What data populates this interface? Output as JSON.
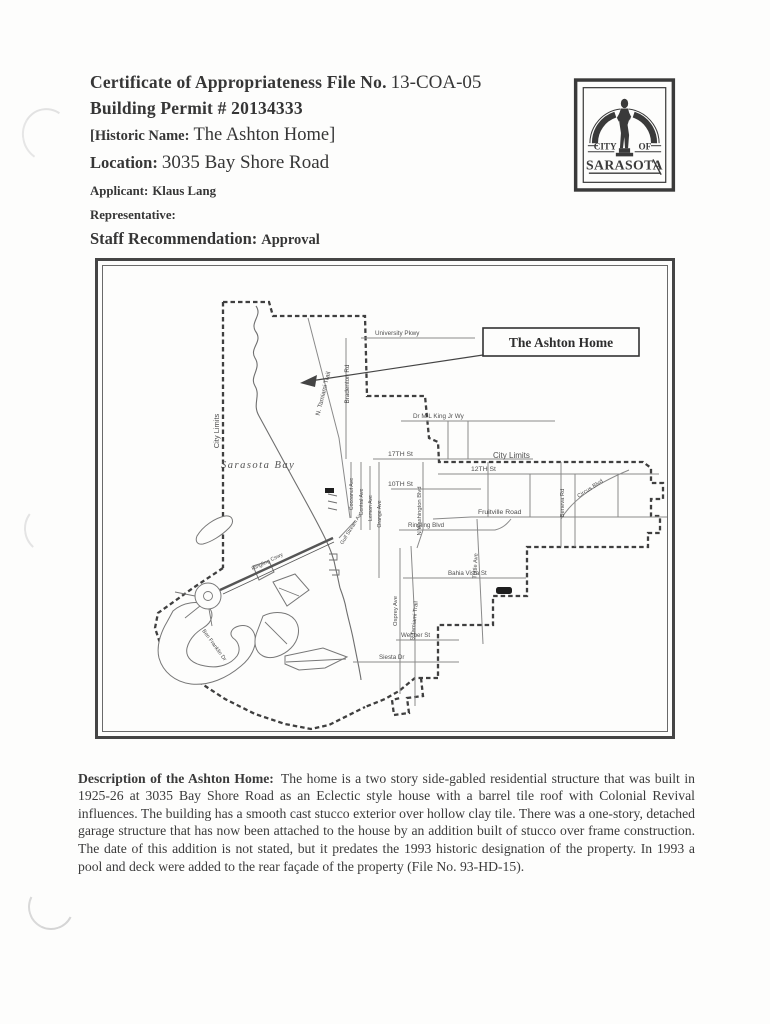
{
  "document": {
    "header": {
      "certificate_label": "Certificate of Appropriateness File No.",
      "certificate_value": "13-COA-05",
      "building_permit": "Building Permit # 20134333",
      "historic_name_label": "[Historic Name:",
      "historic_name_value": "The Ashton Home]",
      "location_label": "Location:",
      "location_value": "3035 Bay Shore Road",
      "applicant_label": "Applicant:",
      "applicant_value": "Klaus Lang",
      "representative_label": "Representative:",
      "staff_recommendation_label": "Staff Recommendation:",
      "staff_recommendation_value": "Approval"
    },
    "logo": {
      "city_word": "CITY",
      "of_word": "OF",
      "name_word": "SARASOTA"
    },
    "map": {
      "callout_label": "The Ashton Home",
      "labels": {
        "city_limits_left": "City Limits",
        "city_limits_right": "City Limits",
        "sarasota_bay": "Sarasota Bay",
        "university_pkwy": "University Pkwy",
        "bradenton_rd": "Bradenton Rd",
        "n_tamiami_trail": "N. Tamiami Trail",
        "mlk_way": "Dr M L King Jr Wy",
        "st_17": "17TH St",
        "st_12": "12TH St",
        "st_10": "10TH St",
        "n_washington": "N Washington Blvd",
        "fruitville": "Fruitville Road",
        "ringling_blvd": "Ringling Blvd",
        "cocoanut_ave": "Cocoanut Ave",
        "central_ave": "Central Ave",
        "lemon_ave": "Lemon Ave",
        "orange_ave": "Orange Ave",
        "gulf_stream": "Gulf Stream Av",
        "tuttle_ave": "Tuttle Ave",
        "beneva_rd": "Beneva Rd",
        "circus_blvd": "Circus Blvd",
        "bahia_vista": "Bahia Vista St",
        "osprey_ave": "Osprey Ave",
        "s_tamiami_trail": "S Tamiami Trail",
        "webber_st": "Webber St",
        "siesta_dr": "Siesta Dr",
        "ringling_cswy": "Ringling Cswy",
        "ben_franklin_dr": "Ben Franklin Dr"
      }
    },
    "description": {
      "heading": "Description of the Ashton Home:",
      "body": "The home is a two story side-gabled residential structure that was built in 1925-26 at 3035 Bay Shore Road as an Eclectic style house with a barrel tile roof with Colonial Revival influences. The building has a smooth cast stucco exterior over hollow clay tile. There was a one-story, detached garage structure that has now been attached to the house by an addition built of stucco over frame construction. The date of this addition is not stated, but it predates the 1993 historic designation of the property. In 1993 a pool and deck were added to the rear façade of the property (File No. 93-HD-15)."
    },
    "colors": {
      "ink": "#363636",
      "map_line": "#6e6e6e",
      "boundary": "#3f3f3f"
    }
  }
}
